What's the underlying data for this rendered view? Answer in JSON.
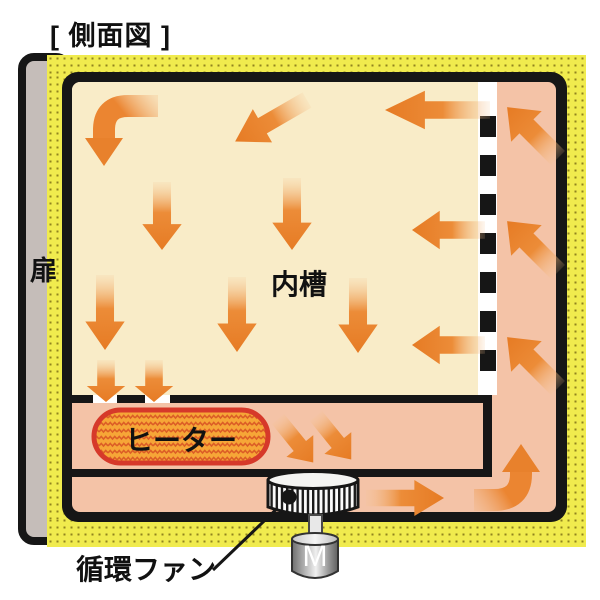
{
  "title": "[ 側面図 ]",
  "labels": {
    "door": "扉",
    "inner_chamber": "内槽",
    "heater": "ヒーター",
    "circulation_fan": "循環ファン",
    "motor": "M"
  },
  "colors": {
    "insulation_yellow": "#F0EB4E",
    "insulation_dots": "#8F831F",
    "duct_pink": "#F4C3A7",
    "chamber_cream": "#F9ECC8",
    "arrow_orange": "#EB8531",
    "heater_fill": "#F6A637",
    "heater_border": "#D6392A",
    "heater_pattern": "#DC5E26",
    "wall_black": "#161616",
    "door_gray": "#C5BDB9"
  }
}
